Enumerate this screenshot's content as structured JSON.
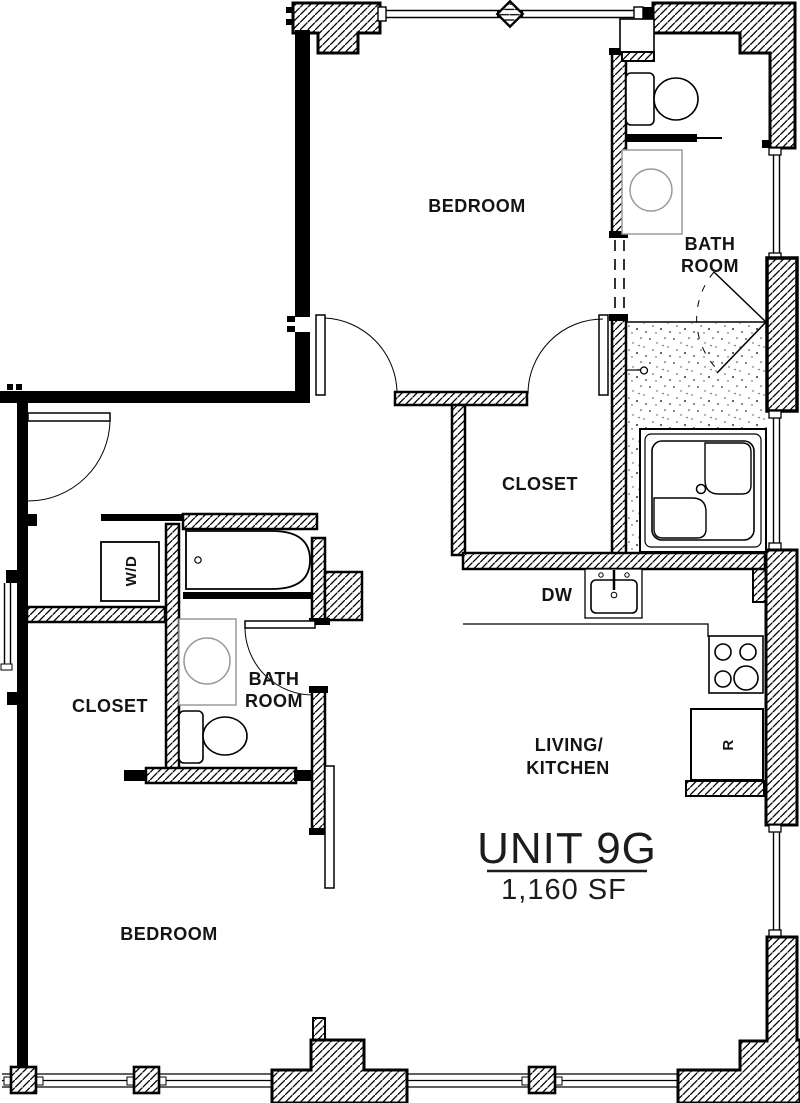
{
  "plan": {
    "unit": {
      "title": "UNIT 9G",
      "area": "1,160 SF"
    },
    "rooms": {
      "bedroom_top": "BEDROOM",
      "bedroom_bottom": "BEDROOM",
      "closet_top": "CLOSET",
      "closet_left": "CLOSET",
      "living_line1": "LIVING/",
      "living_line2": "KITCHEN",
      "bath_top_line1": "BATH",
      "bath_top_line2": "ROOM",
      "bath_left_line1": "BATH",
      "bath_left_line2": "ROOM"
    },
    "fixtures": {
      "washer_dryer": "W/D",
      "dishwasher": "DW",
      "refrigerator": "R"
    },
    "colors": {
      "line": "#000000",
      "fixture_gray": "#9a9a9a",
      "paper": "#ffffff"
    }
  }
}
